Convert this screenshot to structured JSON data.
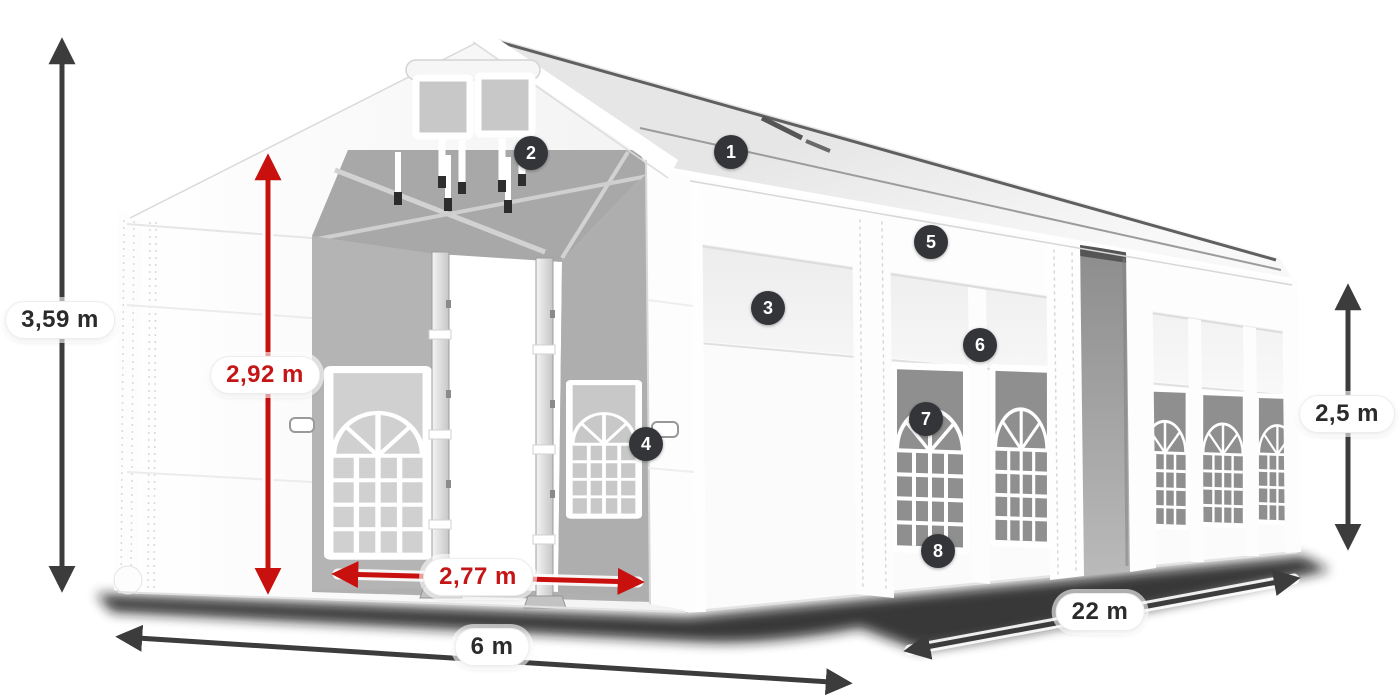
{
  "dimensions": {
    "total_height": {
      "label": "3,59 m"
    },
    "entrance_height": {
      "label": "2,92 m"
    },
    "entrance_width": {
      "label": "2,77 m"
    },
    "width": {
      "label": "6 m"
    },
    "length": {
      "label": "22 m"
    },
    "side_height": {
      "label": "2,5 m"
    }
  },
  "markers": [
    {
      "label": "1"
    },
    {
      "label": "2"
    },
    {
      "label": "3"
    },
    {
      "label": "4"
    },
    {
      "label": "5"
    },
    {
      "label": "6"
    },
    {
      "label": "7"
    },
    {
      "label": "8"
    }
  ],
  "colors": {
    "accent_red": "#c8100f",
    "arrow_dark": "#3c3c3c",
    "badge_background": "#333538",
    "background": "#ffffff"
  }
}
